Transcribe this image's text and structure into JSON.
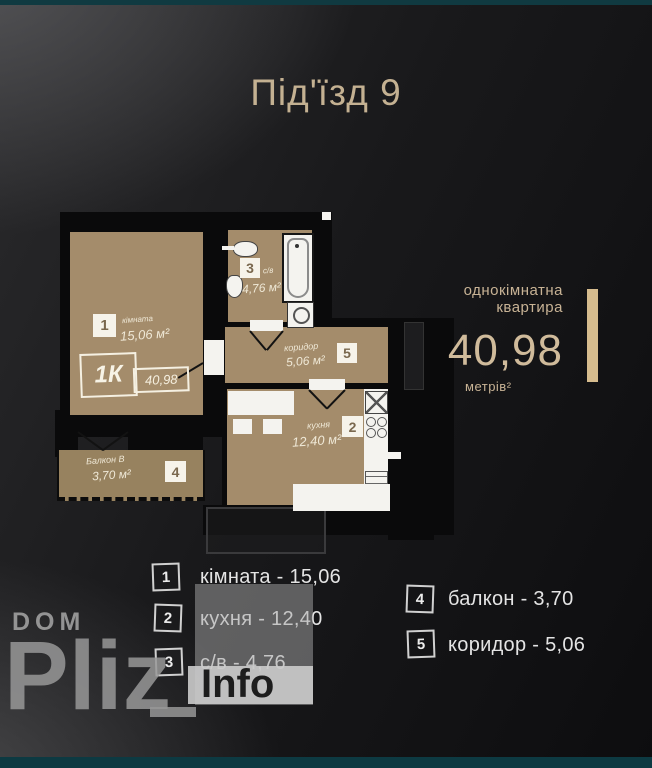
{
  "title": "Під'їзд 9",
  "colors": {
    "background_dark": "#0d0d0f",
    "background_light_corner": "#3a3a3c",
    "room_fill_tan": "#a48c6b",
    "balcony_fill_tan": "#97825f",
    "wall_black": "#0a0a0b",
    "accent_beige_text": "#c4b192",
    "gold_bar": "#d6bc8e",
    "teal_strip": "#103a41",
    "legend_text": "#e4e4e4",
    "watermark_grey": "#989898"
  },
  "plan": {
    "stamp": {
      "type": "1К",
      "total": "40,98"
    },
    "rooms": {
      "kimnata": {
        "num": "1",
        "name": "кімната",
        "area": "15,06 м²"
      },
      "sanvuzol": {
        "num": "3",
        "name": "с/в",
        "area": "4,76 м²"
      },
      "koridor": {
        "num": "5",
        "name": "коридор",
        "area": "5,06 м²"
      },
      "kuhnya": {
        "num": "2",
        "name": "кухня",
        "area": "12,40 м²"
      },
      "balkon": {
        "num": "4",
        "name": "Балкон В",
        "area": "3,70 м²"
      }
    },
    "fixtures": [
      "bathtub",
      "washing-machine",
      "sink",
      "toilet",
      "kitchen-table",
      "chairs",
      "kitchen-sink",
      "stove-burners",
      "fridge"
    ]
  },
  "info_panel": {
    "type_line1": "однокімнатна",
    "type_line2": "квартира",
    "area": "40,98",
    "unit": "метрів²"
  },
  "legend": {
    "items": [
      {
        "num": "1",
        "label": "кімната - 15,06"
      },
      {
        "num": "2",
        "label": "кухня - 12,40"
      },
      {
        "num": "3",
        "label": "с/в - 4,76"
      },
      {
        "num": "4",
        "label": "балкон - 3,70"
      },
      {
        "num": "5",
        "label": "коридор - 5,06"
      }
    ]
  },
  "watermark": {
    "brand_top": "DOM",
    "brand_main": "Pliz",
    "badge": "Info"
  }
}
